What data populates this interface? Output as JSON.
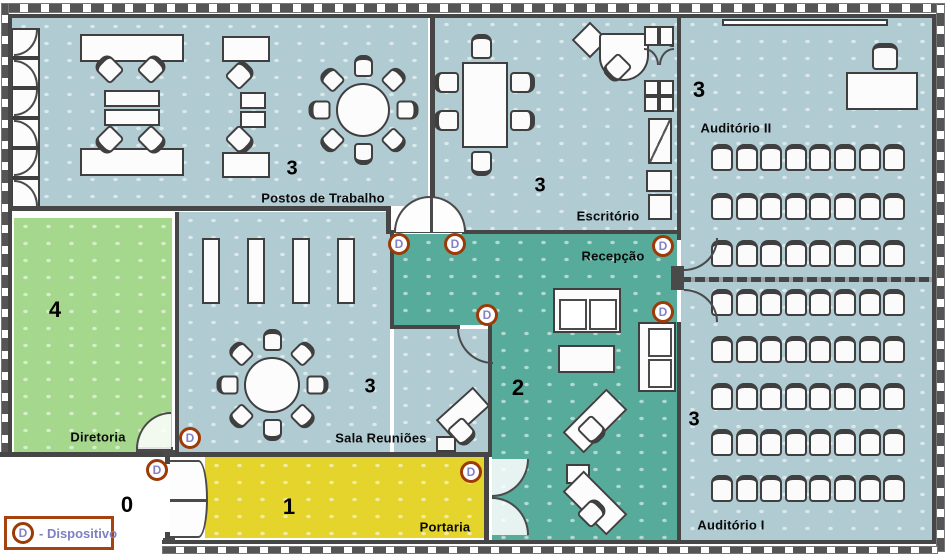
{
  "rooms": [
    {
      "id": "postos-de-trabalho",
      "label": "Postos de Trabalho",
      "number": "3"
    },
    {
      "id": "escritorio",
      "label": "Escritório",
      "number": "3"
    },
    {
      "id": "auditorio-ii",
      "label": "Auditório II",
      "number": "3"
    },
    {
      "id": "recepcao",
      "label": "Recepção",
      "number": "2"
    },
    {
      "id": "sala-reunioes",
      "label": "Sala Reuniões",
      "number": "3"
    },
    {
      "id": "diretoria",
      "label": "Diretoria",
      "number": "4"
    },
    {
      "id": "portaria",
      "label": "Portaria",
      "number": "1"
    },
    {
      "id": "auditorio-i",
      "label": "Auditório I",
      "number": "3"
    },
    {
      "id": "exterior",
      "label": "",
      "number": "0"
    }
  ],
  "devices": {
    "letter": "D",
    "count": 8
  },
  "legend": {
    "symbol": "D",
    "text": "- Dispositivo"
  },
  "colors": {
    "room_blue": "#b1cbd3",
    "hall_teal": "#57ab9b",
    "diretoria_green": "#a5d88c",
    "portaria_yellow": "#e4d42c",
    "wall": "#464646",
    "device_ring": "#9c3a08",
    "device_letter": "#8282c4",
    "legend_border": "#a84110",
    "legend_text": "#7f7fc4"
  }
}
